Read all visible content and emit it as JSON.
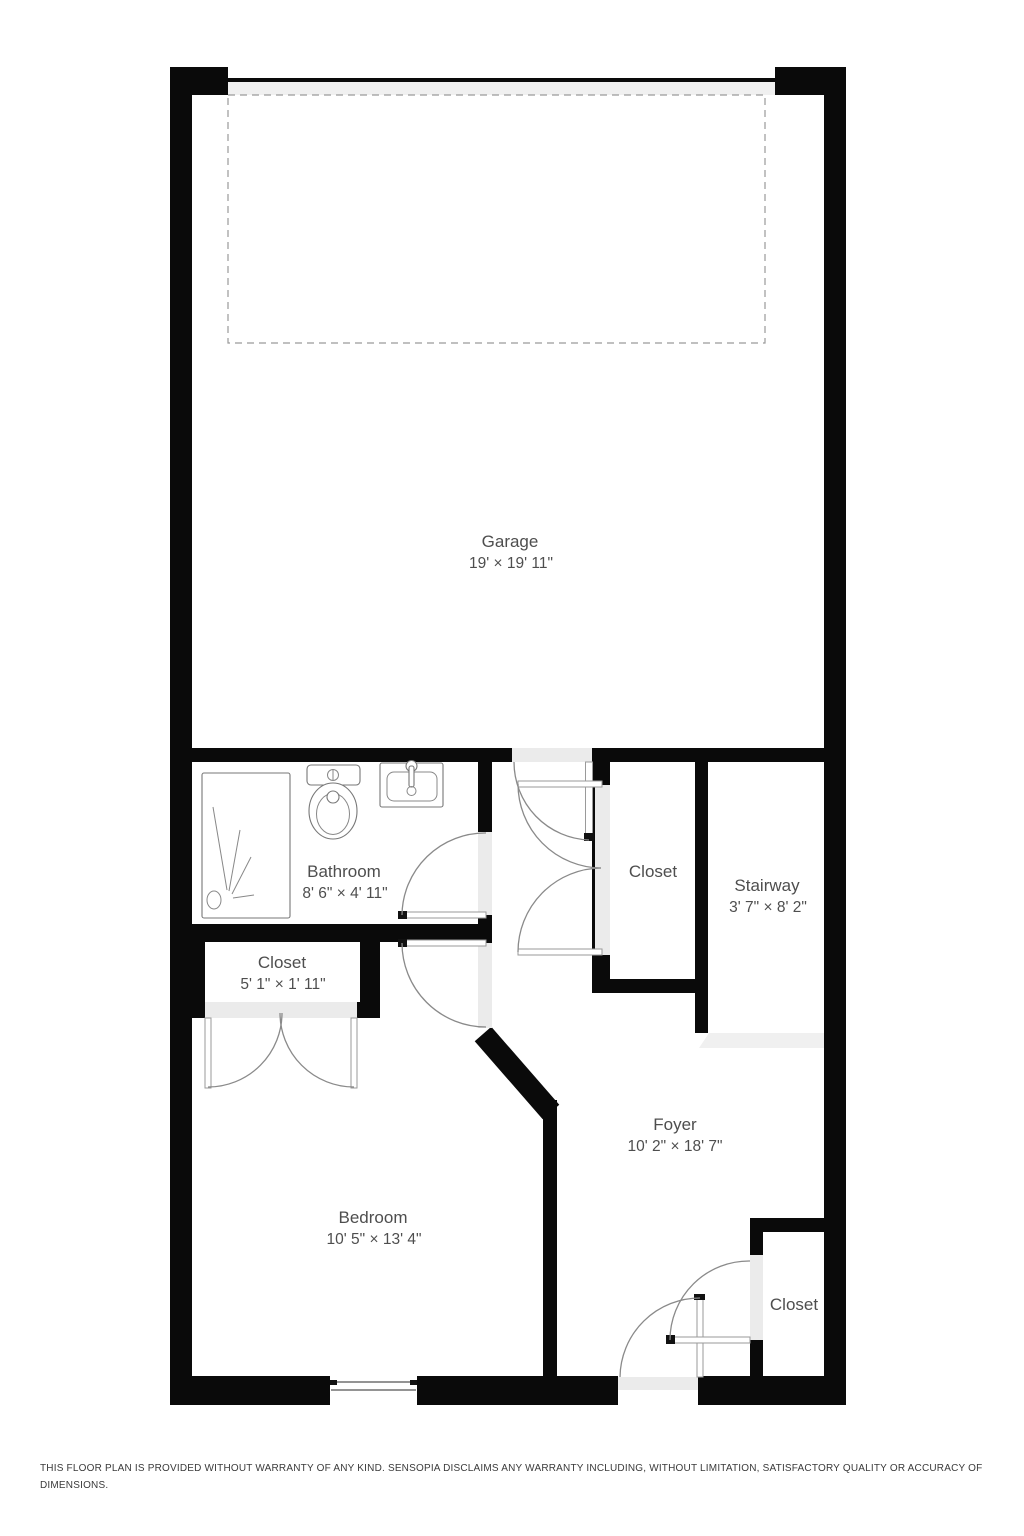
{
  "plan": {
    "rooms": {
      "garage": {
        "name": "Garage",
        "dims": "19' × 19' 11\""
      },
      "bathroom": {
        "name": "Bathroom",
        "dims": "8' 6\" × 4' 11\""
      },
      "hall_closet": {
        "name": "Closet"
      },
      "stairway": {
        "name": "Stairway",
        "dims": "3' 7\" × 8' 2\""
      },
      "bedroom_closet": {
        "name": "Closet",
        "dims": "5' 1\" × 1' 11\""
      },
      "foyer": {
        "name": "Foyer",
        "dims": "10' 2\" × 18' 7\""
      },
      "bedroom": {
        "name": "Bedroom",
        "dims": "10' 5\" × 13' 4\""
      },
      "foyer_closet": {
        "name": "Closet"
      }
    },
    "disclaimer": {
      "line1": "THIS FLOOR PLAN IS PROVIDED WITHOUT WARRANTY OF ANY KIND. SENSOPIA DISCLAIMS ANY WARRANTY INCLUDING, WITHOUT LIMITATION, SATISFACTORY QUALITY OR ACCURACY OF",
      "line2": "DIMENSIONS."
    }
  },
  "colors": {
    "wall": "#0a0a0a",
    "threshold": "#ebebeb",
    "door_arc": "#8a8a8a",
    "label": "#4e4e4e"
  }
}
